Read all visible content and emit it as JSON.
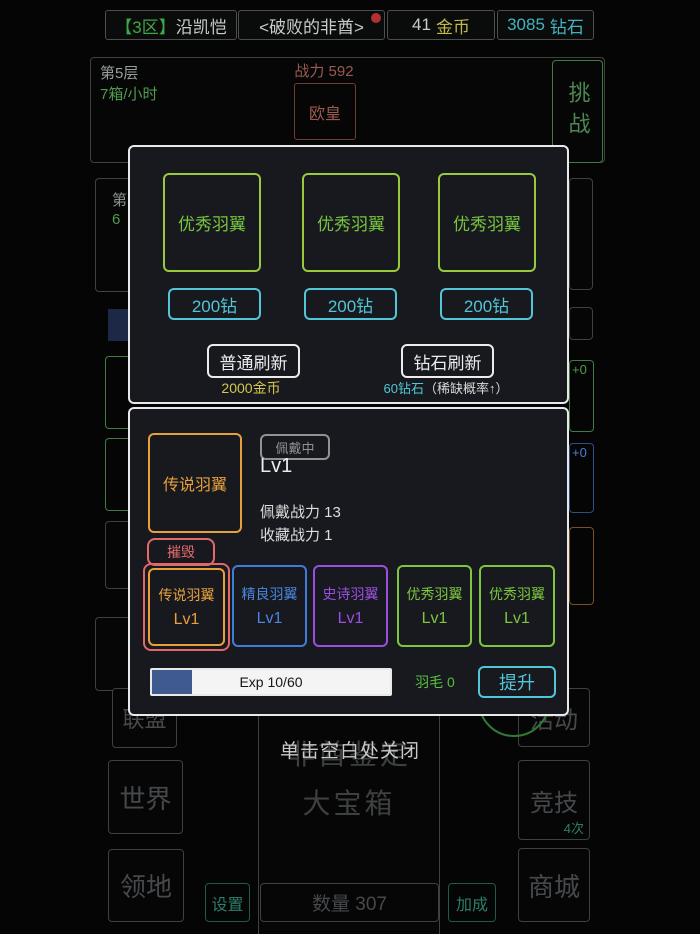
{
  "top_bar": {
    "server_zone": "【3区】",
    "player_name": "沿凯恺",
    "guild_title": "<破败的非酋>",
    "gold_value": "41",
    "gold_unit": "金币",
    "diamond_value": "3085",
    "diamond_unit": "钻石"
  },
  "battle_panel": {
    "floor": "第5层",
    "chest_rate": "7箱/小时",
    "enemy_power": "战力 592",
    "enemy_name": "欧皇",
    "challenge_label": "挑战"
  },
  "background_fragments": {
    "floor2_prefix": "第",
    "floor2_number": "6",
    "slot_green_plus": "+0",
    "slot_blue_plus": "+0"
  },
  "wing_shop": {
    "items": [
      {
        "name": "优秀羽翼",
        "price": "200钻"
      },
      {
        "name": "优秀羽翼",
        "price": "200钻"
      },
      {
        "name": "优秀羽翼",
        "price": "200钻"
      }
    ],
    "normal_refresh_label": "普通刷新",
    "normal_refresh_cost": "2000金币",
    "diamond_refresh_label": "钻石刷新",
    "diamond_refresh_cost": "60钻石",
    "diamond_refresh_note": "（稀缺概率↑）"
  },
  "wing_detail": {
    "selected_name": "传说羽翼",
    "equipped_badge": "佩戴中",
    "level": "Lv1",
    "wear_power": "佩戴战力 13",
    "collection_power": "收藏战力 1",
    "destroy_label": "摧毁",
    "wings": [
      {
        "name": "传说羽翼",
        "level": "Lv1"
      },
      {
        "name": "精良羽翼",
        "level": "Lv1"
      },
      {
        "name": "史诗羽翼",
        "level": "Lv1"
      },
      {
        "name": "优秀羽翼",
        "level": "Lv1"
      },
      {
        "name": "优秀羽翼",
        "level": "Lv1"
      }
    ],
    "exp_label": "Exp 10/60",
    "exp_percent": 17,
    "feather_label": "羽毛 0",
    "upgrade_label": "提升"
  },
  "overlay_hint": "单击空白处关闭",
  "bottom_menu": {
    "alliance": "联盟",
    "world": "世界",
    "territory": "领地",
    "activity": "活动",
    "arena": "竞技",
    "arena_count": "4次",
    "shop": "商城",
    "chest_title": "非酋鉴定",
    "chest_subtitle": "大宝箱",
    "count_label": "数量 307",
    "settings": "设置",
    "bonus": "加成"
  },
  "colors": {
    "accent_cyan": "#52c5d6",
    "accent_green": "#8bc63e",
    "accent_yellow": "#d4c74b",
    "rarity_legend": "#e8a03c",
    "rarity_epic": "#9b4fe0",
    "rarity_fine": "#3f7bd8",
    "rarity_good": "#7dc63e",
    "danger_red": "#e36a6a",
    "exp_fill_blue": "#3e5a8e"
  }
}
